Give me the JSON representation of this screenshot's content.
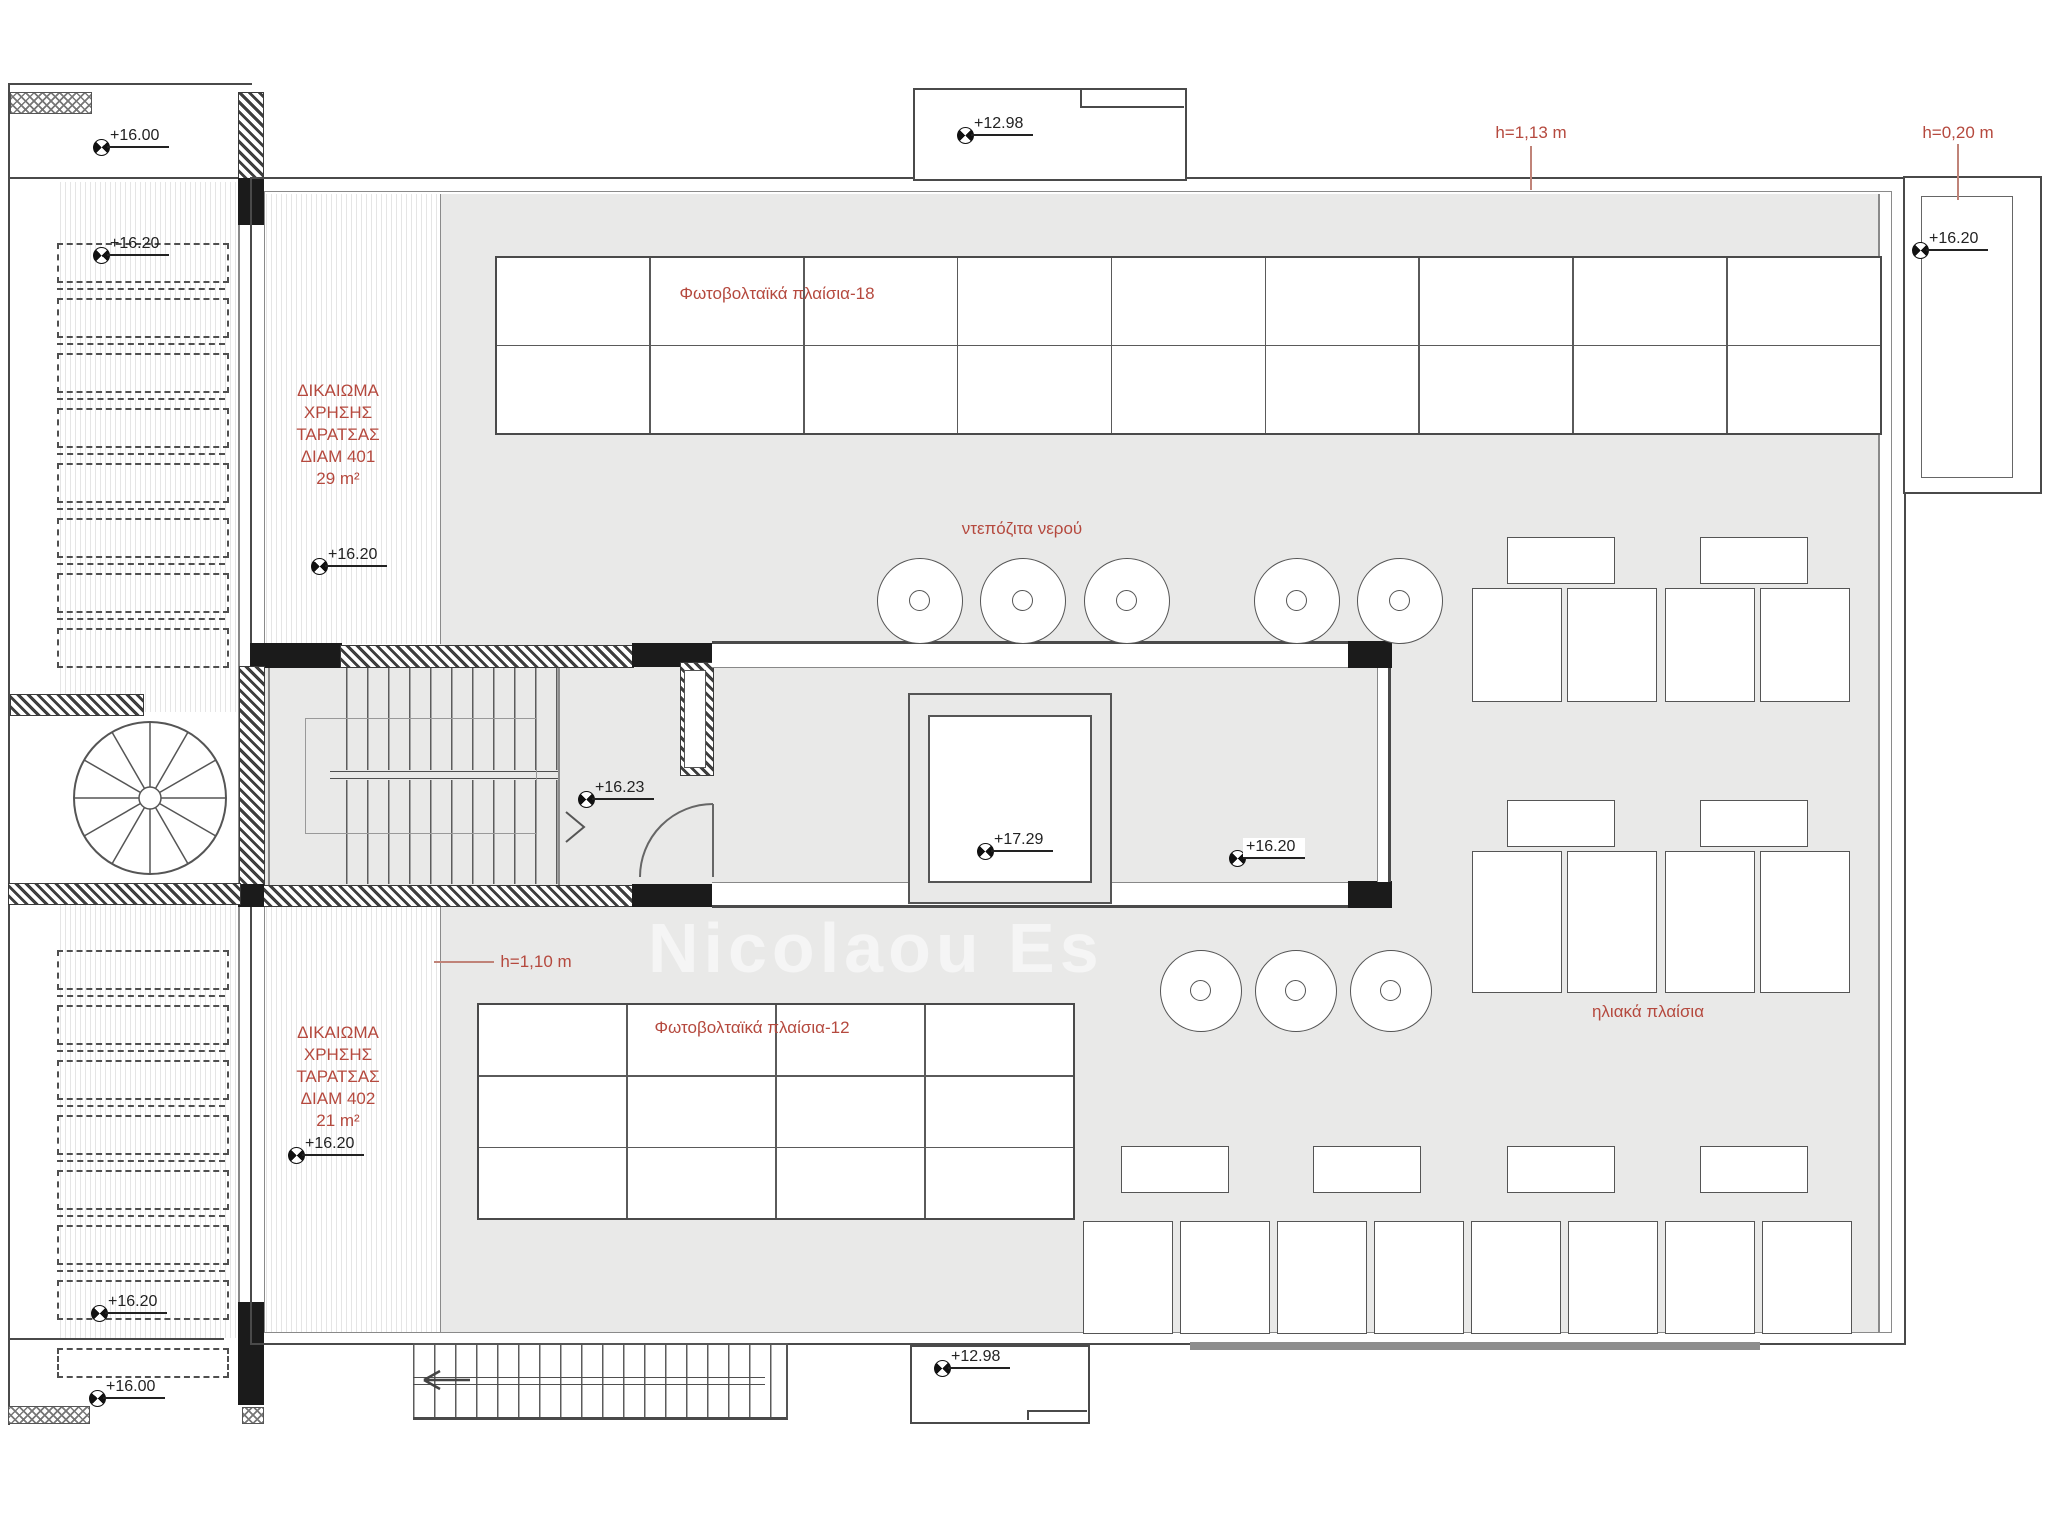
{
  "drawing": {
    "type": "architectural-roof-plan",
    "watermark": "Nicolaou Es"
  },
  "colors": {
    "annotation_red": "#b5493e",
    "terrace_gray": "#e9e9e8",
    "line": "#4a4a4a"
  },
  "annotations": {
    "right_of_use_top": {
      "lines": [
        "ΔΙΚΑΙΩΜΑ",
        "ΧΡΗΣΗΣ",
        "ΤΑΡΑΤΣΑΣ",
        "ΔΙΑΜ 401"
      ],
      "area": "29 m²"
    },
    "right_of_use_bottom": {
      "lines": [
        "ΔΙΚΑΙΩΜΑ",
        "ΧΡΗΣΗΣ",
        "ΤΑΡΑΤΣΑΣ",
        "ΔΙΑΜ 402"
      ],
      "area": "21 m²"
    }
  },
  "red_labels": [
    {
      "text": "Φωτοβολταϊκά πλαίσια-18",
      "x": 777,
      "y": 294
    },
    {
      "text": "ντεπόζιτα νερού",
      "x": 1022,
      "y": 529
    },
    {
      "text": "h=1,13 m",
      "x": 1531,
      "y": 133
    },
    {
      "text": "h=0,20 m",
      "x": 1958,
      "y": 133
    },
    {
      "text": "h=1,10 m",
      "x": 536,
      "y": 962
    },
    {
      "text": "Φωτοβολταϊκά πλαίσια-12",
      "x": 752,
      "y": 1028
    },
    {
      "text": "ηλιακά πλαίσια",
      "x": 1648,
      "y": 1012
    }
  ],
  "leaders": [
    {
      "x": 1530,
      "y": 146,
      "w": 2,
      "h": 44
    },
    {
      "x": 1957,
      "y": 144,
      "w": 2,
      "h": 56
    },
    {
      "x": 434,
      "y": 961,
      "w": 60,
      "h": 2
    }
  ],
  "markers": [
    {
      "value": "+16.00",
      "x": 101,
      "y": 147,
      "wbg": false
    },
    {
      "value": "+16.20",
      "x": 101,
      "y": 255,
      "wbg": false
    },
    {
      "value": "+16.20",
      "x": 319,
      "y": 566,
      "wbg": false
    },
    {
      "value": "+16.23",
      "x": 586,
      "y": 799,
      "wbg": false
    },
    {
      "value": "+17.29",
      "x": 985,
      "y": 851,
      "wbg": false
    },
    {
      "value": "+16.20",
      "x": 1237,
      "y": 858,
      "wbg": true
    },
    {
      "value": "+16.20",
      "x": 1920,
      "y": 250,
      "wbg": false
    },
    {
      "value": "+16.20",
      "x": 296,
      "y": 1155,
      "wbg": false
    },
    {
      "value": "+16.20",
      "x": 99,
      "y": 1313,
      "wbg": false
    },
    {
      "value": "+16.00",
      "x": 97,
      "y": 1398,
      "wbg": false
    },
    {
      "value": "+12.98",
      "x": 965,
      "y": 135,
      "wbg": false
    },
    {
      "value": "+12.98",
      "x": 942,
      "y": 1368,
      "wbg": false
    }
  ],
  "geometry": {
    "pv_grids": [
      {
        "name": "photovoltaic-array-18",
        "x": 495,
        "y": 256,
        "w": 1383,
        "h": 175,
        "cols": 9,
        "rows": 2
      },
      {
        "name": "photovoltaic-array-12",
        "x": 477,
        "y": 1003,
        "w": 594,
        "h": 213,
        "cols": 4,
        "rows": 3
      }
    ],
    "tank_circles": [
      {
        "name": "water-tank",
        "cy": 600,
        "r": 42,
        "cx": [
          919,
          1022,
          1126,
          1296,
          1399
        ]
      },
      {
        "name": "water-tank",
        "cy": 990,
        "r": 40,
        "cx": [
          1200,
          1295,
          1390
        ]
      }
    ],
    "solar_tanks": [
      {
        "x": 1507,
        "y": 537
      },
      {
        "x": 1700,
        "y": 537
      },
      {
        "x": 1507,
        "y": 800
      },
      {
        "x": 1700,
        "y": 800
      },
      {
        "x": 1121,
        "y": 1146
      },
      {
        "x": 1313,
        "y": 1146
      },
      {
        "x": 1507,
        "y": 1146
      },
      {
        "x": 1700,
        "y": 1146
      }
    ],
    "solar_tank_size": {
      "w": 106,
      "h": 45
    },
    "solar_panels": [
      {
        "y": 588,
        "h": 112,
        "w": 88,
        "xs": [
          1472,
          1567,
          1665,
          1760
        ]
      },
      {
        "y": 851,
        "h": 140,
        "w": 88,
        "xs": [
          1472,
          1567,
          1665,
          1760
        ]
      },
      {
        "y": 1221,
        "h": 111,
        "w": 88,
        "xs": [
          1083,
          1180,
          1277,
          1374,
          1471,
          1568,
          1665,
          1762
        ]
      }
    ],
    "dashed_rows": [
      {
        "x": 57,
        "w": 168,
        "h": 36,
        "ys": [
          243,
          298,
          353,
          408,
          463,
          518,
          573,
          628
        ]
      },
      {
        "x": 57,
        "w": 168,
        "h": 36,
        "ys": [
          950,
          1005,
          1060,
          1115,
          1170,
          1225,
          1280
        ]
      },
      {
        "x": 57,
        "w": 168,
        "h": 26,
        "ys": [
          1348
        ]
      }
    ],
    "dash_gap_lines": [
      {
        "x": 57,
        "w": 168,
        "ys": [
          288,
          343,
          398,
          453,
          508,
          563,
          618
        ]
      },
      {
        "x": 57,
        "w": 168,
        "ys": [
          995,
          1050,
          1105,
          1160,
          1215,
          1270
        ]
      }
    ],
    "spiral_stair": {
      "cx": 150,
      "cy": 798,
      "r": 76,
      "inner_r": 11,
      "steps": 12
    }
  }
}
